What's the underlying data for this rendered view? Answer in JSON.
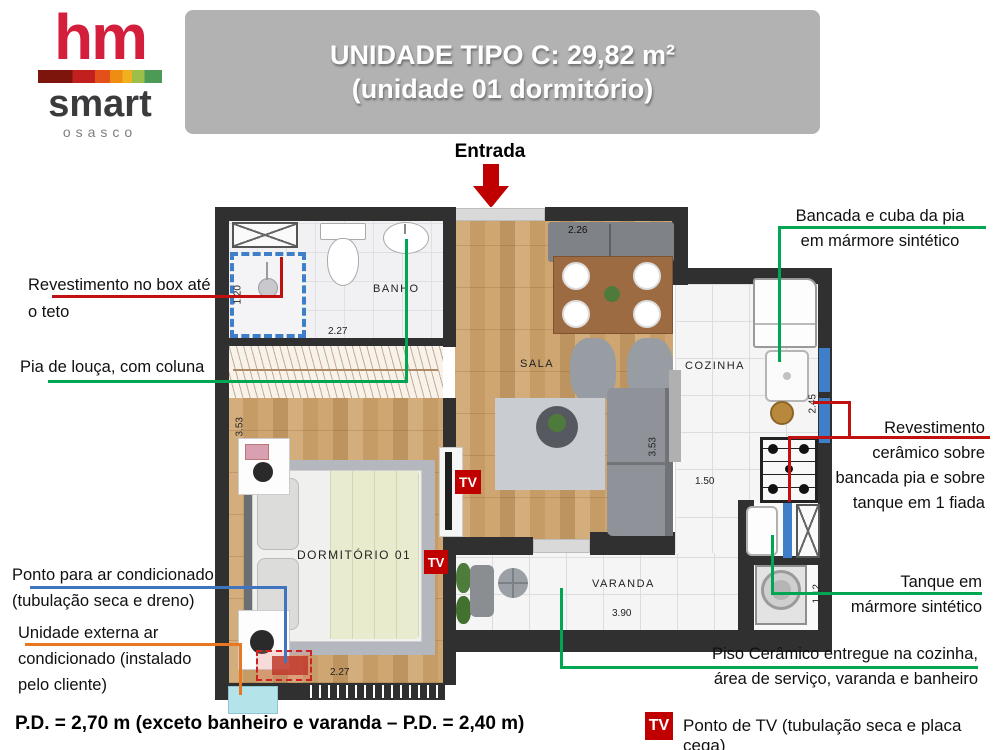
{
  "logo": {
    "hm": "hm",
    "smart": "smart",
    "city": "osasco"
  },
  "banner": {
    "line1": "UNIDADE TIPO C: 29,82 m²",
    "line2": "(unidade 01 dormitório)"
  },
  "plan": {
    "entrada": "Entrada",
    "tv": "TV",
    "labels": {
      "banho": "BANHO",
      "sala": "SALA",
      "cozinha": "COZINHA",
      "dormitorio": "DORMITÓRIO 01",
      "varanda": "VARANDA"
    },
    "dims": {
      "sala_top": "2.26",
      "banho_w": "2.27",
      "shower_h": "1.20",
      "dorm_h": "3.53",
      "dorm_w": "2.27",
      "sala_h": "3.53",
      "cozinha_w": "1.50",
      "cozinha_h": "2.45",
      "varanda_w": "3.90",
      "varanda_h": "0.74",
      "servico_h": "1.12"
    }
  },
  "annotations": {
    "rev_box": {
      "lines": [
        "Revestimento no box até",
        "o teto"
      ],
      "color": "#c11010"
    },
    "pia": {
      "lines": [
        "Pia de louça, com coluna"
      ],
      "color": "#00a651"
    },
    "ponto_ac": {
      "lines": [
        "Ponto para ar condicionado",
        "(tubulação seca e dreno)"
      ],
      "color": "#3f74bf"
    },
    "unidade_ext": {
      "lines": [
        "Unidade externa ar",
        "condicionado (instalado",
        "pelo cliente)"
      ],
      "color": "#e87722"
    },
    "bancada": {
      "lines": [
        "Bancada e cuba da pia",
        "em mármore sintético"
      ],
      "color": "#00a651"
    },
    "revest_cer": {
      "lines": [
        "Revestimento",
        "cerâmico sobre",
        "bancada pia e sobre",
        "tanque em 1 fiada"
      ],
      "color": "#c11010"
    },
    "tanque": {
      "lines": [
        "Tanque em",
        "mármore sintético"
      ],
      "color": "#00a651"
    },
    "piso": {
      "lines": [
        "Piso Cerâmico entregue na cozinha,",
        "área de serviço, varanda e banheiro"
      ],
      "color": "#00a651"
    }
  },
  "footer": {
    "pd_note": "P.D. = 2,70 m (exceto banheiro e varanda – P.D. = 2,40 m)",
    "tv_label": "TV",
    "tv_legend": "Ponto de TV (tubulação seca e placa cega)"
  },
  "colors": {
    "annotation_red": "#c11010",
    "annotation_green": "#00a651",
    "annotation_blue": "#3f74bf",
    "annotation_orange": "#e87722",
    "tv_red": "#c00000",
    "banner_gray": "#b2b2b2",
    "logo_red": "#d41f3c",
    "wall_dark": "#303030",
    "window_blue": "#3f7ec9",
    "ac_external_cyan": "#b5e3ea"
  }
}
